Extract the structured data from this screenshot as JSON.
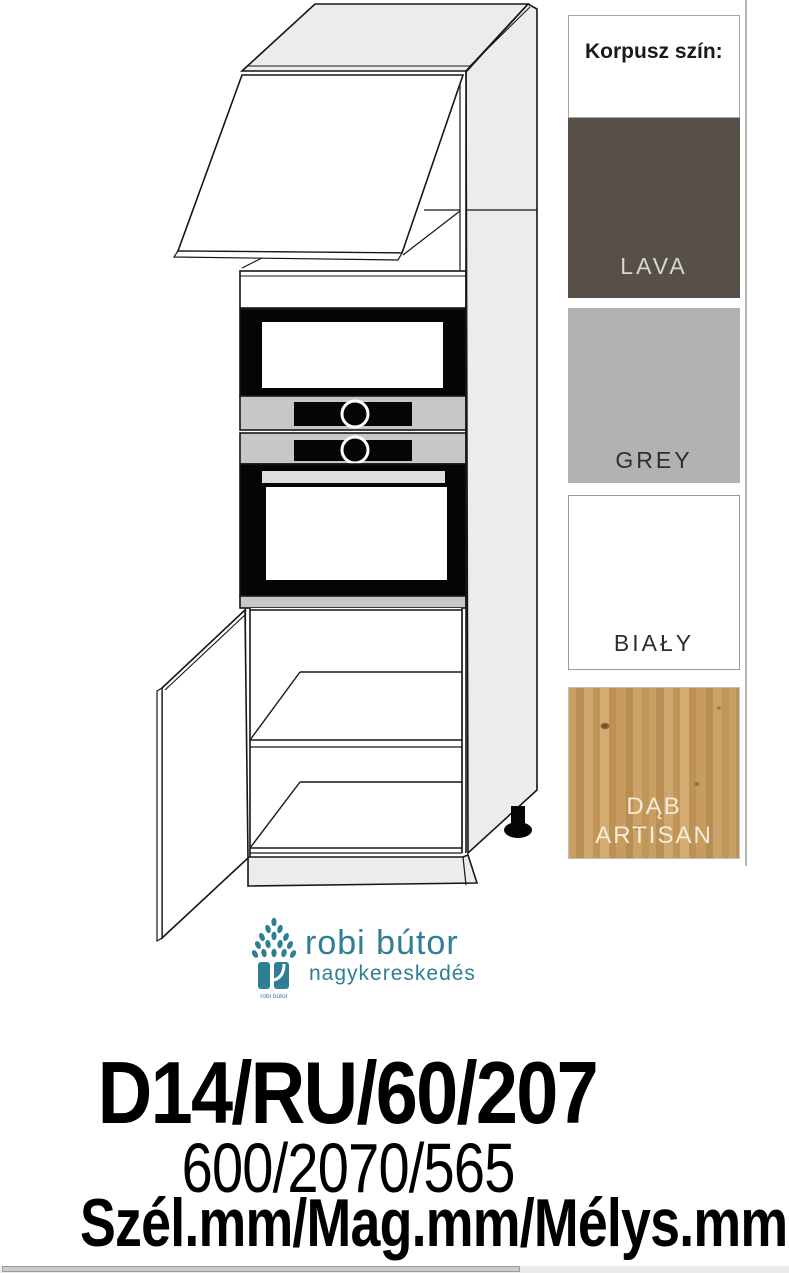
{
  "swatch_panel": {
    "title": "Korpusz szín:",
    "swatches": [
      {
        "name": "LAVA",
        "color": "#575049",
        "text_color": "#d8d6d3"
      },
      {
        "name": "GREY",
        "color": "#b2b2b2",
        "text_color": "#2e2e2e"
      },
      {
        "name": "BIAŁY",
        "color": "#ffffff",
        "text_color": "#2e2e2e"
      },
      {
        "name": "DĄB ARTISAN",
        "color": "#c49a5e",
        "text_color": "#f6ecd9"
      }
    ]
  },
  "logo": {
    "brand": "robi bútor",
    "subtitle": "nagykereskedés",
    "icon_caption": "robi bútor",
    "accent_color": "#2e7e95"
  },
  "product": {
    "code": "D14/RU/60/207",
    "dimensions": "600/2070/565",
    "dimension_labels": "Szél.mm/Mag.mm/Mélys.mm"
  }
}
